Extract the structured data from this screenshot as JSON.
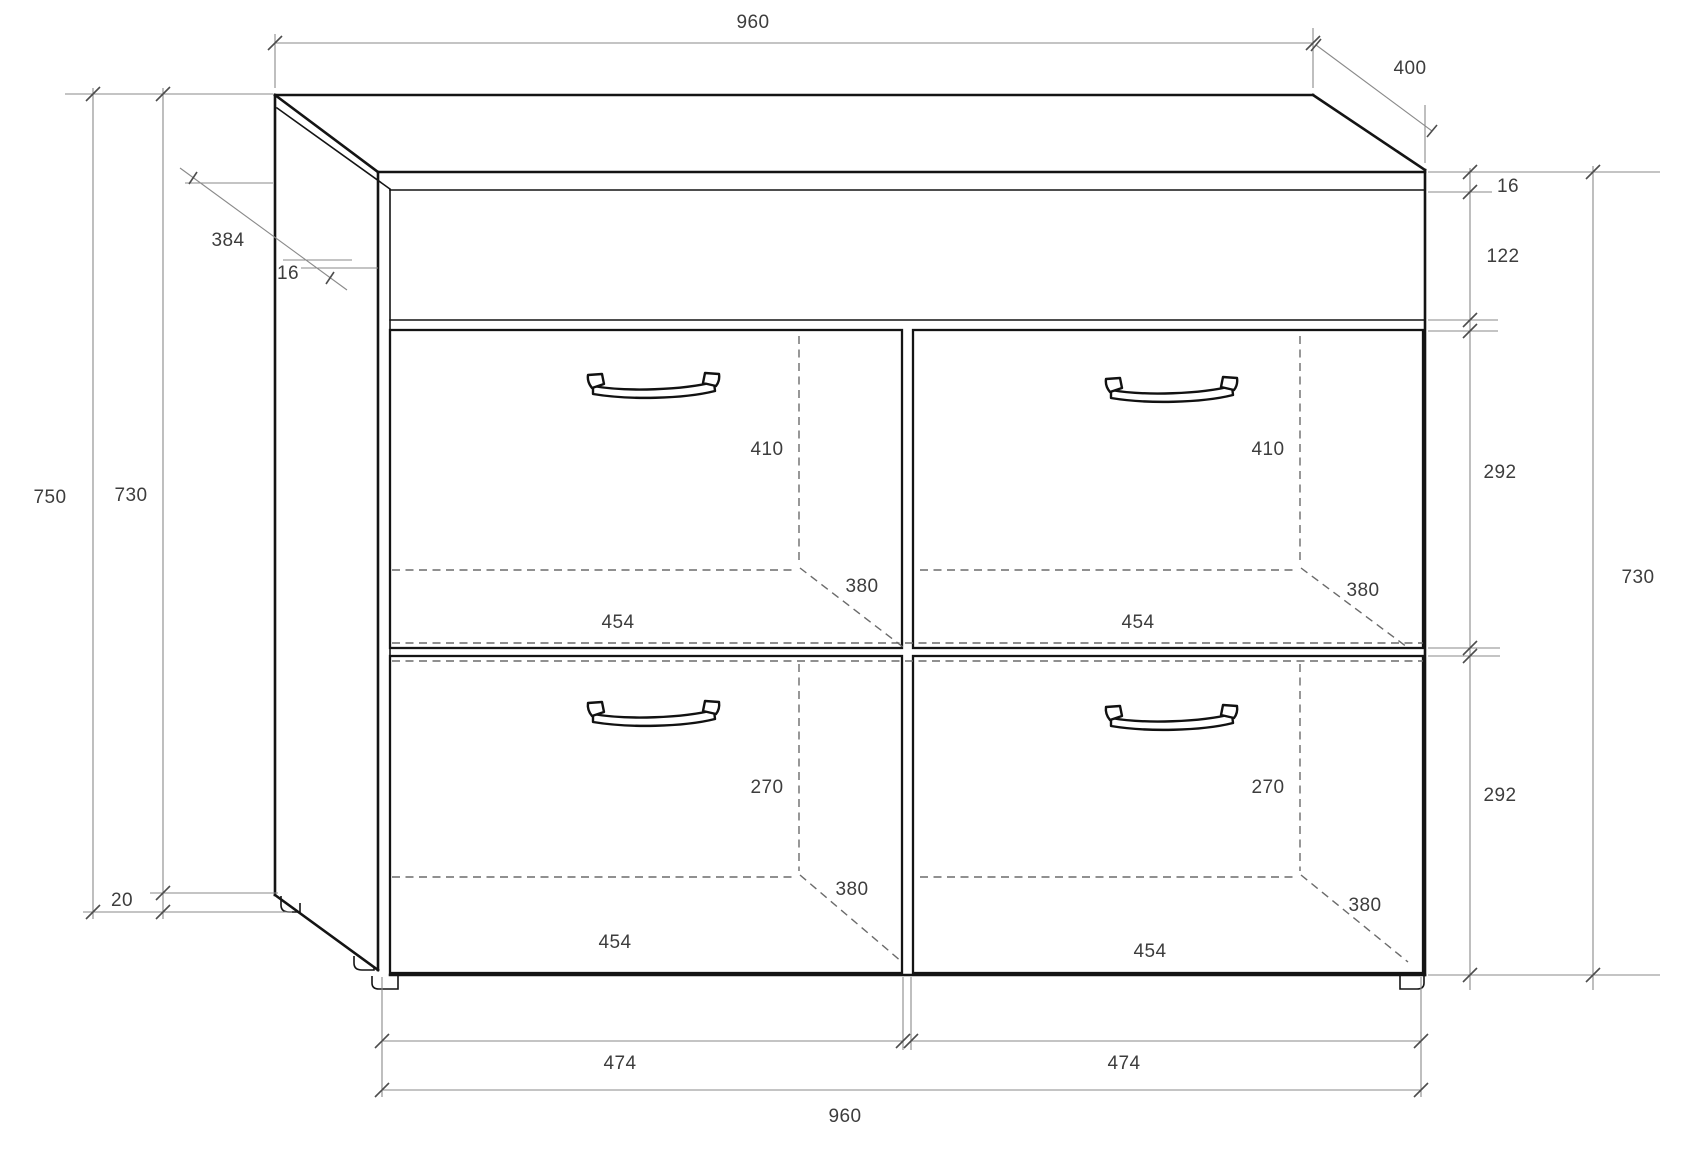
{
  "drawing": {
    "title": "cabinet-dimension-drawing",
    "description": "technical drawing of a two-by-two drawer chest with top apron",
    "overall": {
      "width": "960",
      "depth": "400",
      "height": "750"
    },
    "line_colors": {
      "outline": "#141414",
      "dimension": "#8a8a8a",
      "hidden": "#6b6b6b",
      "label_text": "#3d3d3d"
    },
    "labels": [
      {
        "name": "top-width",
        "value": "960"
      },
      {
        "name": "depth",
        "value": "400"
      },
      {
        "name": "side-depth",
        "value": "384"
      },
      {
        "name": "side-panel-thickness",
        "value": "16"
      },
      {
        "name": "total-height",
        "value": "750"
      },
      {
        "name": "carcass-height-left",
        "value": "730"
      },
      {
        "name": "plinth-height",
        "value": "20"
      },
      {
        "name": "top-thickness",
        "value": "16"
      },
      {
        "name": "apron-height",
        "value": "122"
      },
      {
        "name": "upper-section-height",
        "value": "292"
      },
      {
        "name": "carcass-height-right",
        "value": "730"
      },
      {
        "name": "lower-section-height",
        "value": "292"
      },
      {
        "name": "upper-left-box-height",
        "value": "410"
      },
      {
        "name": "upper-right-box-height",
        "value": "410"
      },
      {
        "name": "upper-left-box-depth",
        "value": "380"
      },
      {
        "name": "upper-right-box-depth",
        "value": "380"
      },
      {
        "name": "upper-left-box-width",
        "value": "454"
      },
      {
        "name": "upper-right-box-width",
        "value": "454"
      },
      {
        "name": "lower-left-box-height",
        "value": "270"
      },
      {
        "name": "lower-right-box-height",
        "value": "270"
      },
      {
        "name": "lower-left-box-depth",
        "value": "380"
      },
      {
        "name": "lower-right-box-depth",
        "value": "380"
      },
      {
        "name": "lower-left-box-width",
        "value": "454"
      },
      {
        "name": "lower-right-box-width",
        "value": "454"
      },
      {
        "name": "left-front-width",
        "value": "474"
      },
      {
        "name": "right-front-width",
        "value": "474"
      },
      {
        "name": "bottom-width",
        "value": "960"
      }
    ]
  }
}
